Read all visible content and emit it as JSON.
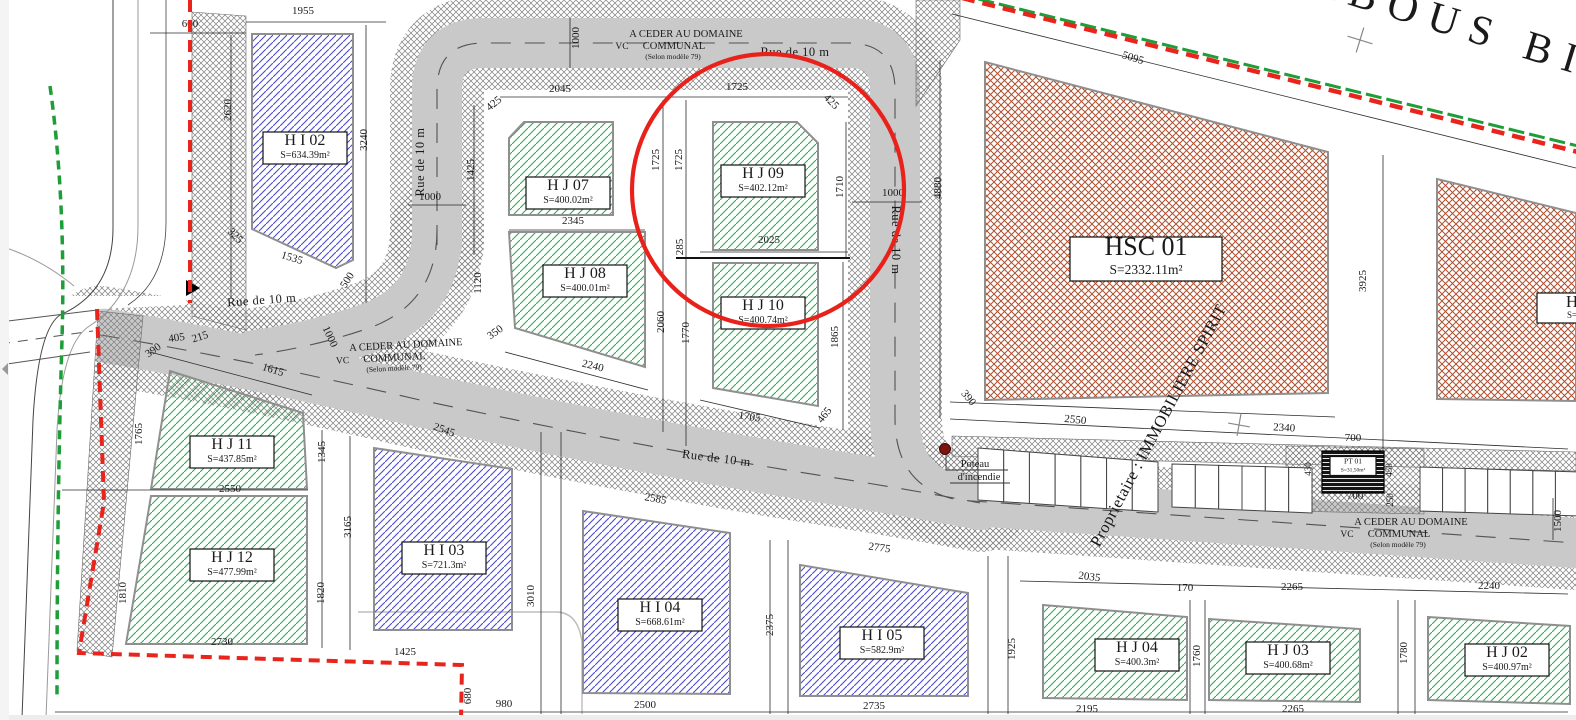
{
  "colors": {
    "road": "#c9c9c9",
    "walk_hatch": "#7f7f7f",
    "green_hatch": "#2fae4d",
    "blue_hatch": "#4b4bd0",
    "red_hatch": "#ae4f2f",
    "boundary_red": "#e8241c",
    "boundary_green": "#1d9e38",
    "highlight_red": "#e8211b",
    "owner_red": "#dd2418",
    "hydrant_red": "#7e1410",
    "ink": "#1a1a1a"
  },
  "parcels": [
    {
      "id": "HI02",
      "label": "H I 02",
      "area": "S=634.39m²",
      "hatch": "blue",
      "size": "std",
      "lx": 305,
      "ly": 148,
      "pts": "252,34 353,34 353,260 336,268 252,229"
    },
    {
      "id": "HJ07",
      "label": "H J 07",
      "area": "S=400.02m²",
      "hatch": "green",
      "size": "std",
      "lx": 568,
      "ly": 193,
      "pts": "509,138 524,122 613,122 613,215 509,215"
    },
    {
      "id": "HJ08",
      "label": "H J 08",
      "area": "S=400.01m²",
      "hatch": "green",
      "size": "std",
      "lx": 585,
      "ly": 281,
      "pts": "509,232 645,232 645,367 515,328"
    },
    {
      "id": "HJ09",
      "label": "H J 09",
      "area": "S=402.12m²",
      "hatch": "green",
      "size": "std",
      "lx": 763,
      "ly": 181,
      "pts": "713,122 797,122 818,143 818,250 713,250"
    },
    {
      "id": "HJ10",
      "label": "H J 10",
      "area": "S=400.74m²",
      "hatch": "green",
      "size": "std",
      "lx": 763,
      "ly": 313,
      "pts": "713,263 818,263 818,406 713,388"
    },
    {
      "id": "HJ11",
      "label": "H J 11",
      "area": "S=437.85m²",
      "hatch": "green",
      "size": "std",
      "lx": 232,
      "ly": 452,
      "pts": "170,371 303,413 307,489 151,489"
    },
    {
      "id": "HJ12",
      "label": "H J 12",
      "area": "S=477.99m²",
      "hatch": "green",
      "size": "std",
      "lx": 232,
      "ly": 565,
      "pts": "151,496 307,496 307,644 126,644"
    },
    {
      "id": "HI03",
      "label": "H I 03",
      "area": "S=721.3m²",
      "hatch": "blue",
      "size": "std",
      "lx": 444,
      "ly": 558,
      "pts": "374,448 512,469 512,630 374,630"
    },
    {
      "id": "HI04",
      "label": "H I 04",
      "area": "S=668.61m²",
      "hatch": "blue",
      "size": "std",
      "lx": 660,
      "ly": 615,
      "pts": "583,511 730,533 730,694 583,693"
    },
    {
      "id": "HI05",
      "label": "H I 05",
      "area": "S=582.9m²",
      "hatch": "blue",
      "size": "std",
      "lx": 882,
      "ly": 643,
      "pts": "800,565 968,593 968,696 800,696"
    },
    {
      "id": "HJ04",
      "label": "H J 04",
      "area": "S=400.3m²",
      "hatch": "green",
      "size": "std",
      "lx": 1137,
      "ly": 655,
      "pts": "1043,605 1187,617 1187,700 1043,698"
    },
    {
      "id": "HJ03",
      "label": "H J 03",
      "area": "S=400.68m²",
      "hatch": "green",
      "size": "std",
      "lx": 1288,
      "ly": 658,
      "pts": "1209,619 1360,629 1360,702 1209,700"
    },
    {
      "id": "HJ02",
      "label": "H J 02",
      "area": "S=400.97m²",
      "hatch": "green",
      "size": "std",
      "lx": 1507,
      "ly": 660,
      "pts": "1428,617 1570,626 1570,704 1428,700"
    },
    {
      "id": "HSC01",
      "label": "HSC 01",
      "area": "S=2332.11m²",
      "hatch": "redx",
      "size": "big",
      "lx": 1146,
      "ly": 259,
      "pts": "985,62 1328,152 1328,393 985,400"
    },
    {
      "id": "HSC02",
      "label": "H",
      "area": "S=",
      "hatch": "redx",
      "size": "edge",
      "lx": 1572,
      "ly": 308,
      "pts": "1437,179 1576,213 1576,401 1437,399"
    },
    {
      "id": "PT01",
      "label": "PT 01",
      "area": "S=31,50m²",
      "hatch": "dark",
      "size": "tiny",
      "lx": 1353,
      "ly": 466,
      "pts": "1322,451 1384,451 1384,493 1322,493"
    }
  ],
  "streets": [
    {
      "label": "Rue de 10 m",
      "x": 795,
      "y": 56,
      "r": 0
    },
    {
      "label": "Rue de 10 m",
      "x": 424,
      "y": 162,
      "r": -90
    },
    {
      "label": "Rue de 10 m",
      "x": 262,
      "y": 304,
      "r": -4
    },
    {
      "label": "Rue de 10 m",
      "x": 892,
      "y": 240,
      "r": 90
    },
    {
      "label": "Rue de 10 m",
      "x": 716,
      "y": 462,
      "r": 7
    }
  ],
  "cession_notes": [
    {
      "cx": 686,
      "y": 37,
      "r": 0,
      "domaine": "A CEDER AU DOMAINE",
      "vc": "VC",
      "communal": "COMMUNAL",
      "selon": "(Selon modèle 79)"
    },
    {
      "cx": 406,
      "y": 348,
      "r": -3,
      "domaine": "A CEDER AU DOMAINE",
      "vc": "VC",
      "communal": "COMMUNAL",
      "selon": "(Selon modèle 79)"
    },
    {
      "cx": 1411,
      "y": 525,
      "r": 0,
      "domaine": "A CEDER AU DOMAINE",
      "vc": "VC",
      "communal": "COMMUNAL",
      "selon": "(Selon modèle 79)"
    }
  ],
  "annotations": {
    "owner_text": "Proprietaire : IMMOBILIERE SPIRIT",
    "habous_text": "ABOUS BI",
    "hydrant_line1": "Poteau",
    "hydrant_line2": "d'incendie",
    "highlight": {
      "cx": 768,
      "cy": 190,
      "r": 136
    },
    "crosses": [
      {
        "x": 1360,
        "y": 40,
        "r": 17,
        "s": 13
      },
      {
        "x": 1239,
        "y": 425,
        "r": 10,
        "s": 11
      }
    ]
  },
  "parking": {
    "groups": [
      {
        "x0": 978,
        "t0": 448,
        "b0": 500,
        "x1": 1158,
        "t1": 462,
        "b1": 512,
        "n": 7
      },
      {
        "x0": 1172,
        "t0": 464,
        "b0": 507,
        "x1": 1312,
        "t1": 468,
        "b1": 513,
        "n": 6
      },
      {
        "x0": 1420,
        "t0": 467,
        "b0": 511,
        "x1": 1578,
        "t1": 472,
        "b1": 516,
        "n": 7
      }
    ]
  },
  "dimensions": [
    {
      "t": "1955",
      "x": 303,
      "y": 14
    },
    {
      "t": "600",
      "x": 190,
      "y": 27
    },
    {
      "t": "2620",
      "x": 231,
      "y": 110,
      "r": -90
    },
    {
      "t": "3240",
      "x": 367,
      "y": 140,
      "r": -90
    },
    {
      "t": "325",
      "x": 233,
      "y": 238,
      "r": 45
    },
    {
      "t": "1535",
      "x": 291,
      "y": 261,
      "r": 17
    },
    {
      "t": "500",
      "x": 350,
      "y": 282,
      "r": -57
    },
    {
      "t": "1000",
      "x": 430,
      "y": 200
    },
    {
      "t": "1000",
      "x": 579,
      "y": 38,
      "r": -90
    },
    {
      "t": "2045",
      "x": 560,
      "y": 92
    },
    {
      "t": "1725",
      "x": 737,
      "y": 90
    },
    {
      "t": "425",
      "x": 496,
      "y": 106,
      "r": -40
    },
    {
      "t": "425",
      "x": 829,
      "y": 104,
      "r": 45
    },
    {
      "t": "1425",
      "x": 474,
      "y": 170,
      "r": -90
    },
    {
      "t": "1725",
      "x": 659,
      "y": 160,
      "r": -90
    },
    {
      "t": "1725",
      "x": 682,
      "y": 160,
      "r": -90
    },
    {
      "t": "1710",
      "x": 843,
      "y": 187,
      "r": -90
    },
    {
      "t": "1000",
      "x": 893,
      "y": 196
    },
    {
      "t": "2345",
      "x": 573,
      "y": 224
    },
    {
      "t": "1120",
      "x": 481,
      "y": 283,
      "r": -90
    },
    {
      "t": "285",
      "x": 683,
      "y": 247,
      "r": -90
    },
    {
      "t": "2025",
      "x": 769,
      "y": 243
    },
    {
      "t": "2060",
      "x": 664,
      "y": 322,
      "r": -90
    },
    {
      "t": "1770",
      "x": 689,
      "y": 333,
      "r": -90
    },
    {
      "t": "1865",
      "x": 838,
      "y": 337,
      "r": -90
    },
    {
      "t": "350",
      "x": 497,
      "y": 335,
      "r": -35
    },
    {
      "t": "2240",
      "x": 592,
      "y": 369,
      "r": 14
    },
    {
      "t": "1705",
      "x": 749,
      "y": 420,
      "r": 9
    },
    {
      "t": "465",
      "x": 827,
      "y": 417,
      "r": -52
    },
    {
      "t": "5095",
      "x": 1132,
      "y": 61,
      "r": 17
    },
    {
      "t": "4880",
      "x": 941,
      "y": 188,
      "r": -90
    },
    {
      "t": "3925",
      "x": 1366,
      "y": 281,
      "r": -90
    },
    {
      "t": "390",
      "x": 966,
      "y": 400,
      "r": 50
    },
    {
      "t": "2550",
      "x": 1075,
      "y": 423,
      "r": 6
    },
    {
      "t": "2340",
      "x": 1284,
      "y": 431,
      "r": 3
    },
    {
      "t": "700",
      "x": 1353,
      "y": 441
    },
    {
      "t": "700",
      "x": 1355,
      "y": 499
    },
    {
      "t": "430",
      "x": 1311,
      "y": 469,
      "r": -90,
      "s": 9
    },
    {
      "t": "450",
      "x": 1392,
      "y": 470,
      "r": -90,
      "s": 9
    },
    {
      "t": "250",
      "x": 1393,
      "y": 500,
      "r": -90,
      "s": 9
    },
    {
      "t": "1500",
      "x": 1561,
      "y": 521,
      "r": -90
    },
    {
      "t": "2035",
      "x": 1089,
      "y": 580,
      "r": 7
    },
    {
      "t": "170",
      "x": 1185,
      "y": 591
    },
    {
      "t": "2265",
      "x": 1292,
      "y": 590
    },
    {
      "t": "2240",
      "x": 1489,
      "y": 589
    },
    {
      "t": "1925",
      "x": 1015,
      "y": 649,
      "r": -90
    },
    {
      "t": "1760",
      "x": 1200,
      "y": 656,
      "r": -90
    },
    {
      "t": "1780",
      "x": 1407,
      "y": 653,
      "r": -90
    },
    {
      "t": "2195",
      "x": 1087,
      "y": 712
    },
    {
      "t": "2265",
      "x": 1293,
      "y": 712
    },
    {
      "t": "390",
      "x": 155,
      "y": 353,
      "r": -35
    },
    {
      "t": "405",
      "x": 177,
      "y": 341,
      "r": -8
    },
    {
      "t": "215",
      "x": 201,
      "y": 340,
      "r": -18
    },
    {
      "t": "1615",
      "x": 272,
      "y": 373,
      "r": 17
    },
    {
      "t": "1765",
      "x": 142,
      "y": 434,
      "r": -90
    },
    {
      "t": "1345",
      "x": 325,
      "y": 452,
      "r": -90
    },
    {
      "t": "2550",
      "x": 230,
      "y": 492
    },
    {
      "t": "3165",
      "x": 351,
      "y": 527,
      "r": -90
    },
    {
      "t": "1810",
      "x": 126,
      "y": 593,
      "r": -90
    },
    {
      "t": "1820",
      "x": 324,
      "y": 593,
      "r": -90
    },
    {
      "t": "1000",
      "x": 327,
      "y": 338,
      "r": 65
    },
    {
      "t": "2545",
      "x": 443,
      "y": 433,
      "r": 20
    },
    {
      "t": "2730",
      "x": 222,
      "y": 645
    },
    {
      "t": "1425",
      "x": 405,
      "y": 655
    },
    {
      "t": "680",
      "x": 471,
      "y": 696,
      "r": -90
    },
    {
      "t": "980",
      "x": 504,
      "y": 707
    },
    {
      "t": "2500",
      "x": 645,
      "y": 708
    },
    {
      "t": "2735",
      "x": 874,
      "y": 709
    },
    {
      "t": "2775",
      "x": 879,
      "y": 551,
      "r": 8
    },
    {
      "t": "2585",
      "x": 655,
      "y": 502,
      "r": 10
    },
    {
      "t": "2375",
      "x": 773,
      "y": 625,
      "r": -90
    },
    {
      "t": "3010",
      "x": 534,
      "y": 596,
      "r": -90
    }
  ]
}
